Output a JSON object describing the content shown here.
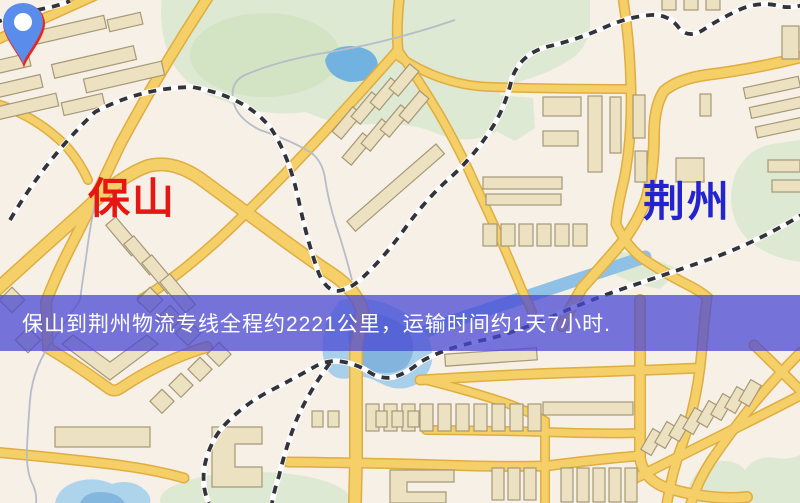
{
  "page": {
    "width": 800,
    "height": 503
  },
  "map": {
    "markers": {
      "origin": {
        "name": "保山",
        "pin_color": "#e9261d",
        "label_color": "#e41712"
      },
      "destination": {
        "name": "荆州",
        "pin_color": "#5a8cec",
        "label_color": "#2424cf"
      }
    },
    "palette": {
      "background": "#f7f0e6",
      "road_fill": "#f5cf68",
      "road_edge": "#dfad42",
      "building_fill": "#ece1c0",
      "building_outline": "#a69878",
      "park_green": "#dde9d2",
      "water_blue": "#8fc0e6",
      "railway_dark": "#33333b",
      "trail_gray": "#b6bcc8"
    }
  },
  "banner": {
    "text": "保山到荆州物流专线全程约2221公里，运输时间约1天7小时.",
    "origin": "保山",
    "destination": "荆州",
    "distance": "约2221公里",
    "duration": "约1天7小时",
    "background_color": "#4848d4",
    "text_color": "#ffffff"
  }
}
